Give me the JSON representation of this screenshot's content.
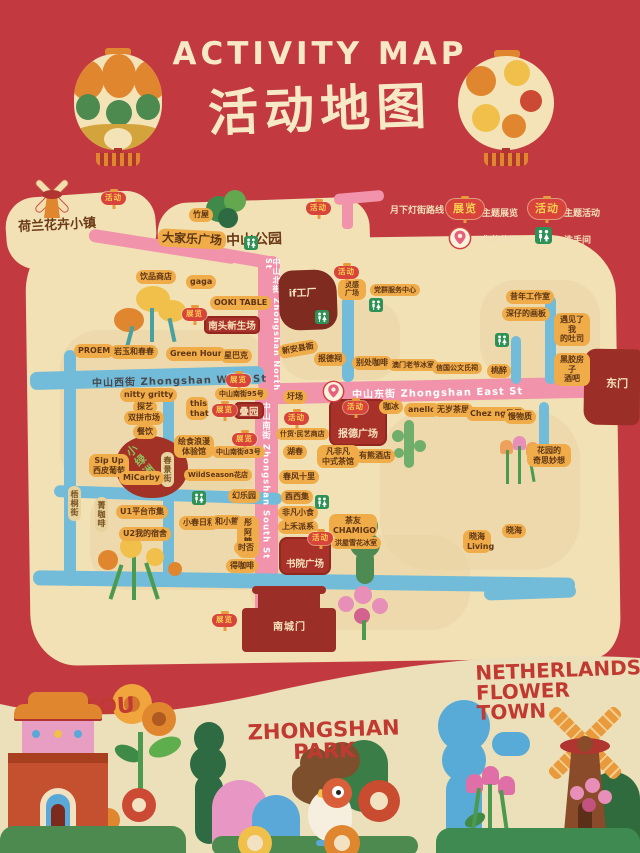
{
  "header": {
    "title_en": "ACTIVITY MAP",
    "title_zh": "活动地图"
  },
  "legend": {
    "route_label": "月下灯街路线",
    "exhibit_badge": "展览",
    "exhibit_label": "主题展览",
    "activity_badge": "活动",
    "activity_label": "主题活动",
    "location_label": "您的位置",
    "restroom_label": "洗手间"
  },
  "colors": {
    "background_red": "#c23a40",
    "map_tan": "#f1e1b4",
    "route_pink": "#f093ab",
    "street_blue": "#72bcd9",
    "label_orange": "#efac49",
    "highlight_red": "#a83129",
    "lantern_red": "#d8433c",
    "lantern_text_yellow": "#f8cf4f",
    "restroom_green": "#2f9156",
    "title_cream": "#f8e9c6",
    "footer_cream": "#ece0ba",
    "footer_text_red": "#c13a31"
  },
  "streets": {
    "north": "中山北街 Zhongshan North St",
    "west": "中山西街  Zhongshan West St",
    "east": "中山东街  Zhongshan East St",
    "south": "中山南街 Zhongshan South St",
    "wutong": "梧桐街",
    "chunjing": "春景街"
  },
  "map": {
    "boxes": {
      "xinsheng": "南头新生场",
      "dieyuan": "叠园",
      "baode": "报德广场",
      "shuyuan": "书院广场",
      "factory": "if工厂",
      "oasis": "小绿洲"
    },
    "gates": {
      "east": "东门",
      "south": "南城门"
    },
    "places": [
      {
        "label": "荷兰花卉小镇",
        "x": 18,
        "y": 214,
        "k": "darktxt",
        "fs": 13,
        "rot": -3,
        "name": "area-netherlands-flower-town"
      },
      {
        "label": "中山公园",
        "x": 226,
        "y": 229,
        "k": "darktxt",
        "fs": 14,
        "rot": -2,
        "name": "area-zhongshan-park"
      },
      {
        "label": "竹屋",
        "x": 189,
        "y": 208
      },
      {
        "label": "大家乐广场",
        "x": 158,
        "y": 230,
        "fs": 12,
        "rot": 3,
        "name": "area-dajiale-plaza"
      },
      {
        "label": "饮品商店",
        "x": 136,
        "y": 270
      },
      {
        "label": "gaga",
        "x": 186,
        "y": 275
      },
      {
        "label": "OOKI TABLE",
        "x": 210,
        "y": 296
      },
      {
        "label": "PROEM",
        "x": 74,
        "y": 344
      },
      {
        "label": "岩玉和春春",
        "x": 110,
        "y": 345
      },
      {
        "label": "Green Hour",
        "x": 166,
        "y": 347
      },
      {
        "label": "星巴克",
        "x": 220,
        "y": 349
      },
      {
        "label": "灵感广场",
        "x": 338,
        "y": 279,
        "k": "pill2",
        "w": 28,
        "fs": 7
      },
      {
        "label": "党群服务中心",
        "x": 370,
        "y": 284,
        "fs": 7
      },
      {
        "label": "昔年工作室",
        "x": 506,
        "y": 290
      },
      {
        "label": "深仔的画板",
        "x": 502,
        "y": 307
      },
      {
        "label": "遇见了我\n的吐司",
        "x": 554,
        "y": 313,
        "k": "pill2",
        "w": 36
      },
      {
        "label": "黑胶房子\n酒吧",
        "x": 554,
        "y": 353,
        "k": "pill2",
        "w": 36
      },
      {
        "label": "新安县衙",
        "x": 278,
        "y": 342,
        "rot": -10
      },
      {
        "label": "报德祠",
        "x": 314,
        "y": 352
      },
      {
        "label": "别处咖啡",
        "x": 352,
        "y": 356
      },
      {
        "label": "澳门老爷冰室",
        "x": 388,
        "y": 359,
        "fs": 7
      },
      {
        "label": "信国公文氏祠",
        "x": 432,
        "y": 362,
        "fs": 7
      },
      {
        "label": "桃醉",
        "x": 487,
        "y": 364
      },
      {
        "label": "nitty gritty",
        "x": 120,
        "y": 388
      },
      {
        "label": "探艺",
        "x": 133,
        "y": 400
      },
      {
        "label": "双拼市场",
        "x": 124,
        "y": 411
      },
      {
        "label": "餐饮",
        "x": 133,
        "y": 425
      },
      {
        "label": "Sip Up\n西皮葡萄",
        "x": 89,
        "y": 454,
        "k": "pill2",
        "w": 40
      },
      {
        "label": "MiCarby",
        "x": 119,
        "y": 471
      },
      {
        "label": "菁咖啡",
        "x": 95,
        "y": 497,
        "k": "vpill"
      },
      {
        "label": "U1平台市集",
        "x": 116,
        "y": 505
      },
      {
        "label": "U2我的宿舍",
        "x": 119,
        "y": 527
      },
      {
        "label": "this\nthat",
        "x": 186,
        "y": 397,
        "k": "pill2",
        "w": 22
      },
      {
        "label": "绘食浪漫\n体验馆",
        "x": 174,
        "y": 435,
        "k": "pill2",
        "w": 40
      },
      {
        "label": "中山南街95号",
        "x": 215,
        "y": 388,
        "fs": 7
      },
      {
        "label": "中山南街83号",
        "x": 212,
        "y": 446,
        "fs": 7
      },
      {
        "label": "WildSeason花店",
        "x": 184,
        "y": 469,
        "fs": 7
      },
      {
        "label": "幻乐园",
        "x": 228,
        "y": 489
      },
      {
        "label": "小春日和",
        "x": 179,
        "y": 516
      },
      {
        "label": "和小熊",
        "x": 211,
        "y": 515
      },
      {
        "label": "彤阿\n糖水",
        "x": 237,
        "y": 516,
        "k": "pill2",
        "w": 22
      },
      {
        "label": "时否",
        "x": 234,
        "y": 541
      },
      {
        "label": "得咖啡",
        "x": 226,
        "y": 559
      },
      {
        "label": "圩场",
        "x": 283,
        "y": 390
      },
      {
        "label": "什货·民艺商店",
        "x": 276,
        "y": 428,
        "fs": 7
      },
      {
        "label": "湖春",
        "x": 283,
        "y": 445
      },
      {
        "label": "凡非凡\n中式茶馆",
        "x": 317,
        "y": 445,
        "k": "pill2",
        "w": 42
      },
      {
        "label": "有熊酒店",
        "x": 355,
        "y": 449
      },
      {
        "label": "春风十里",
        "x": 279,
        "y": 470
      },
      {
        "label": "酉西集",
        "x": 281,
        "y": 490
      },
      {
        "label": "非凡小食",
        "x": 278,
        "y": 506
      },
      {
        "label": "上禾派系",
        "x": 278,
        "y": 520
      },
      {
        "label": "茶友\nCHAMIGO",
        "x": 329,
        "y": 514,
        "k": "pill2",
        "w": 48
      },
      {
        "label": "洪屋雪花冰室",
        "x": 331,
        "y": 537,
        "fs": 7
      },
      {
        "label": "咖冰",
        "x": 379,
        "y": 400
      },
      {
        "label": "anello",
        "x": 404,
        "y": 403
      },
      {
        "label": "无岁茶居",
        "x": 433,
        "y": 403
      },
      {
        "label": "Chez ng吴居",
        "x": 466,
        "y": 407
      },
      {
        "label": "慢物质",
        "x": 504,
        "y": 410
      },
      {
        "label": "花园的\n奇思妙想",
        "x": 527,
        "y": 444,
        "k": "pill2",
        "w": 44
      },
      {
        "label": "晓海",
        "x": 502,
        "y": 524
      },
      {
        "label": "晓海\nLiving",
        "x": 463,
        "y": 530,
        "k": "pill2",
        "w": 28
      }
    ],
    "badges": [
      {
        "t": "activity",
        "x": 101,
        "y": 192
      },
      {
        "t": "activity",
        "x": 306,
        "y": 202
      },
      {
        "t": "activity",
        "x": 334,
        "y": 266
      },
      {
        "t": "activity",
        "x": 343,
        "y": 401
      },
      {
        "t": "activity",
        "x": 284,
        "y": 412
      },
      {
        "t": "activity",
        "x": 308,
        "y": 532
      },
      {
        "t": "exhibit",
        "x": 182,
        "y": 308
      },
      {
        "t": "exhibit",
        "x": 226,
        "y": 374
      },
      {
        "t": "exhibit",
        "x": 212,
        "y": 404
      },
      {
        "t": "exhibit",
        "x": 232,
        "y": 433
      },
      {
        "t": "exhibit",
        "x": 212,
        "y": 614
      }
    ],
    "restrooms": [
      [
        244,
        236
      ],
      [
        369,
        298
      ],
      [
        315,
        310
      ],
      [
        495,
        333
      ],
      [
        192,
        491
      ],
      [
        315,
        495
      ]
    ],
    "pin": {
      "x": 322,
      "y": 380
    }
  },
  "footer": {
    "left_title": "NANTOU\nCITY",
    "center_title": "ZHONGSHAN\nPARK",
    "right_title": "NETHERLANDS\nFLOWER TOWN"
  },
  "icons": {
    "lantern_left": "festival-lantern-icon",
    "lantern_right": "flower-lantern-icon",
    "route": "pink-road-icon",
    "location": "map-pin-icon",
    "restroom": "restroom-icon",
    "windmill": "windmill-icon",
    "trees": "tree-icon",
    "flowers": "flower-icon",
    "bird": "bird-icon",
    "city_gate": "city-gate-icon"
  }
}
